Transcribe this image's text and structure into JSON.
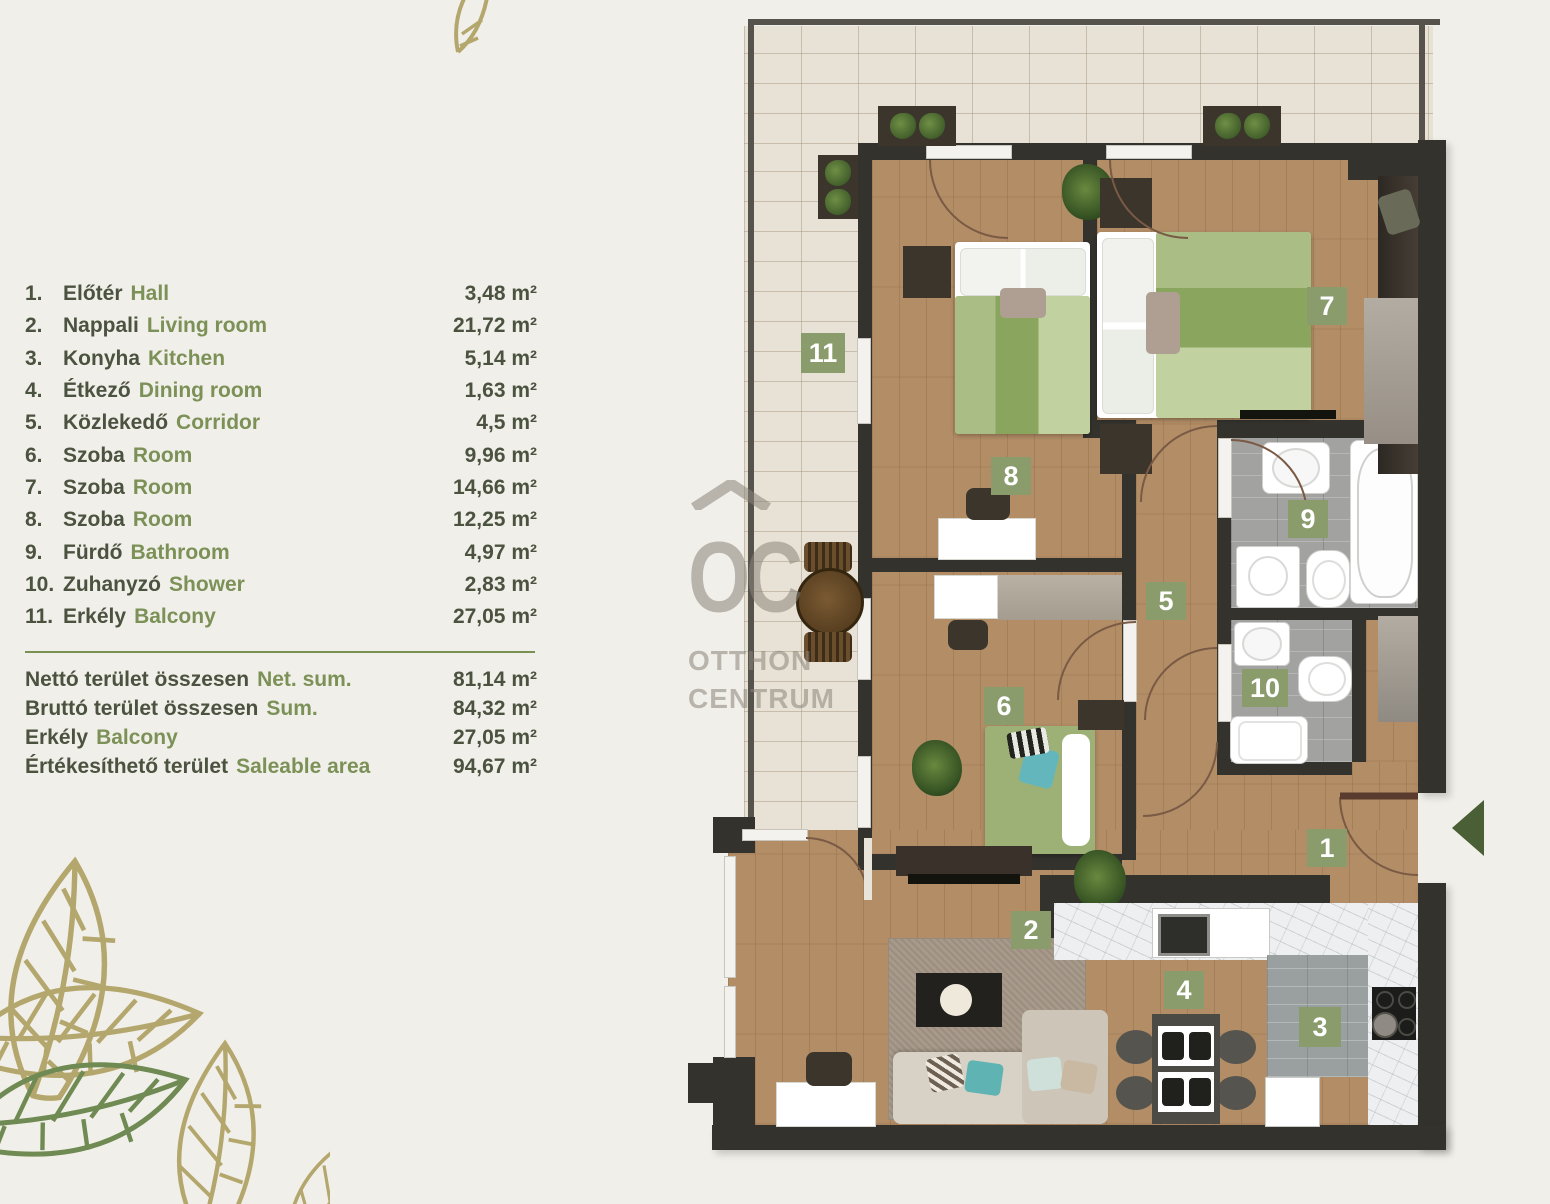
{
  "palette": {
    "background": "#f1efe9",
    "text_dark_green": "#4b5340",
    "text_light_green": "#7c9157",
    "badge_green": "#8a9b6c",
    "wall_dark": "#33322d",
    "wood_floor": "#b28d66",
    "balcony_tile": "#e8e1d5",
    "bath_tile": "#a2a2a0",
    "entry_arrow_green": "#4a5f35",
    "watermark_gray": "#8a857c",
    "leaf_tan": "#b4a76d",
    "leaf_green": "#6f8a52"
  },
  "legend": {
    "items": [
      {
        "no": "1.",
        "hu": "Előtér",
        "en": "Hall",
        "area": "3,48 m²"
      },
      {
        "no": "2.",
        "hu": "Nappali",
        "en": "Living room",
        "area": "21,72 m²"
      },
      {
        "no": "3.",
        "hu": "Konyha",
        "en": "Kitchen",
        "area": "5,14 m²"
      },
      {
        "no": "4.",
        "hu": "Étkező",
        "en": "Dining room",
        "area": "1,63 m²"
      },
      {
        "no": "5.",
        "hu": "Közlekedő",
        "en": "Corridor",
        "area": "4,5 m²"
      },
      {
        "no": "6.",
        "hu": "Szoba",
        "en": "Room",
        "area": "9,96 m²"
      },
      {
        "no": "7.",
        "hu": "Szoba",
        "en": "Room",
        "area": "14,66 m²"
      },
      {
        "no": "8.",
        "hu": "Szoba",
        "en": "Room",
        "area": "12,25 m²"
      },
      {
        "no": "9.",
        "hu": "Fürdő",
        "en": "Bathroom",
        "area": "4,97 m²"
      },
      {
        "no": "10.",
        "hu": "Zuhanyzó",
        "en": "Shower",
        "area": "2,83 m²"
      },
      {
        "no": "11.",
        "hu": "Erkély",
        "en": "Balcony",
        "area": "27,05 m²"
      }
    ],
    "summary": [
      {
        "hu": "Nettó terület összesen",
        "en": "Net. sum.",
        "area": "81,14 m²"
      },
      {
        "hu": "Bruttó terület összesen",
        "en": "Sum.",
        "area": "84,32 m²"
      },
      {
        "hu": "Erkély",
        "en": "Balcony",
        "area": "27,05 m²"
      },
      {
        "hu": "Értékesíthető terület",
        "en": "Saleable area",
        "area": "94,67 m²"
      }
    ]
  },
  "watermark": {
    "logo": "OC",
    "line1": "OTTHON",
    "line2": "CENTRUM"
  },
  "plan": {
    "room_labels": [
      {
        "no": "11"
      },
      {
        "no": "8"
      },
      {
        "no": "7"
      },
      {
        "no": "9"
      },
      {
        "no": "5"
      },
      {
        "no": "10"
      },
      {
        "no": "6"
      },
      {
        "no": "1"
      },
      {
        "no": "2"
      },
      {
        "no": "4"
      },
      {
        "no": "3"
      }
    ]
  }
}
